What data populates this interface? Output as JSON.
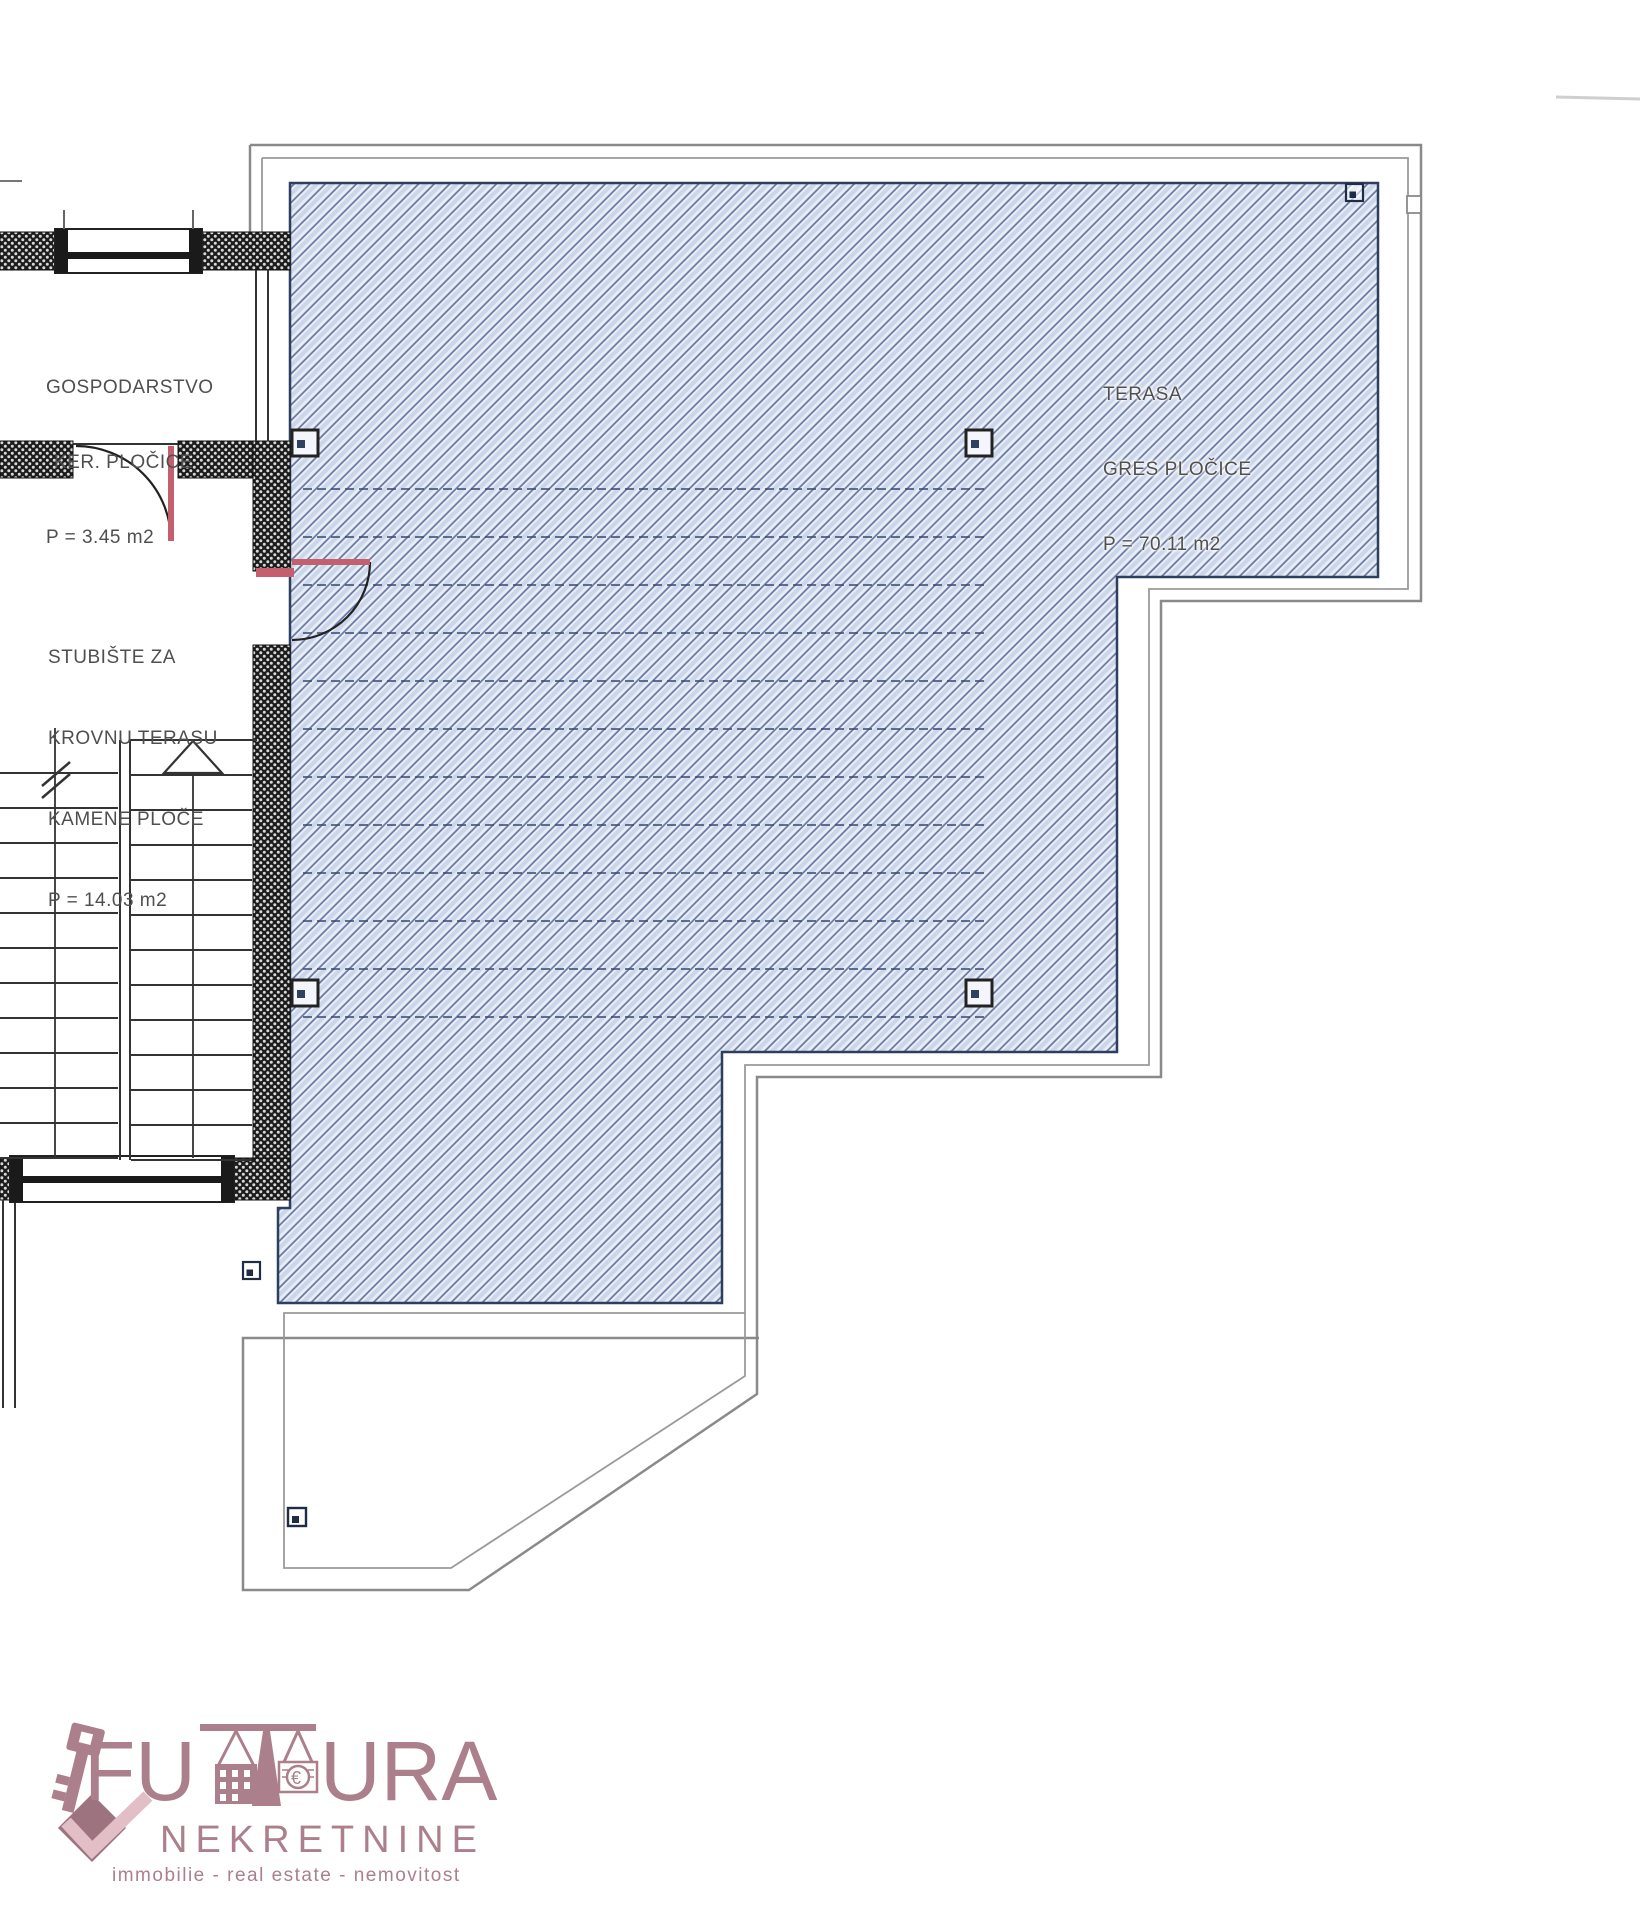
{
  "plan": {
    "rooms": [
      {
        "name": "gospodarstvo",
        "lines": [
          "GOSPODARSTVO",
          "KER. PLOČICE",
          "P = 3.45 m2"
        ]
      },
      {
        "name": "stubiste-za-krovnu-terasu",
        "lines": [
          "STUBIŠTE ZA",
          "KROVNU TERASU",
          "KAMENE PLOČE",
          "P = 14.03 m2"
        ]
      },
      {
        "name": "terasa",
        "lines": [
          "TERASA",
          "GRES PLOČICE",
          "P = 70.11 m2"
        ]
      }
    ]
  },
  "logo": {
    "brand": "FUTURA",
    "brand_left": "FU",
    "brand_right": "URA",
    "subtitle": "NEKRETNINE",
    "tagline": "immobilie - real estate - nemovitost",
    "euro_symbol": "€"
  },
  "colors": {
    "hatch_bg": "#e9edf6",
    "hatch_band": "#ccd6ea",
    "hatch_line": "#63749f",
    "hatch_edge": "#2e3e5e",
    "wall_fill": "#1c1c1c",
    "door_red": "#c4606e",
    "outline_gray": "#8a8a8a",
    "label_text": "#4f4f4f",
    "logo_mauve": "#ab7f8c",
    "logo_light_pink": "#e2bfc7"
  }
}
